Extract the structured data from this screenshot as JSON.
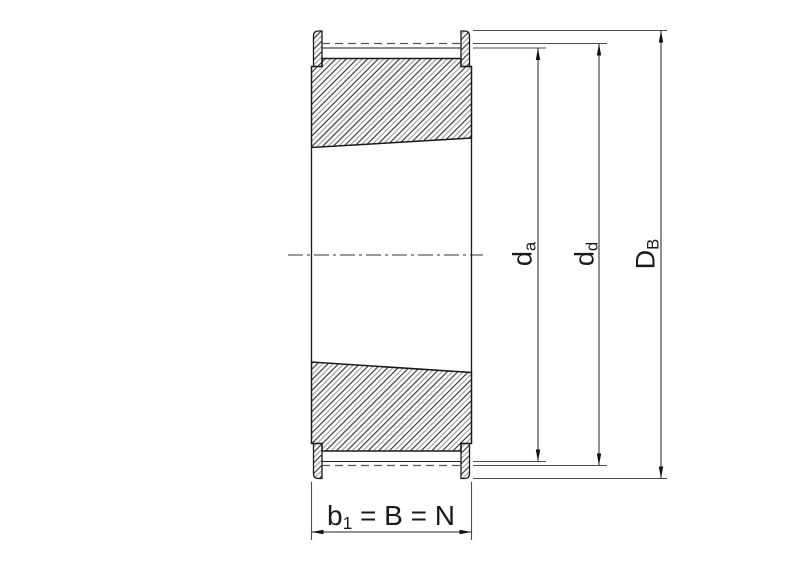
{
  "drawing": {
    "type": "technical-cross-section",
    "subject": "timing-belt pulley with taper bore and flanges",
    "labels": {
      "width_dim": {
        "base": "b",
        "sub": "1",
        "rest": " = B = N"
      },
      "tip_diameter": {
        "base": "d",
        "sub": "a"
      },
      "pitch_diameter": {
        "base": "d",
        "sub": "d"
      },
      "flange_diameter": {
        "base": "D",
        "sub": "B"
      }
    },
    "colors": {
      "line": "#1a1a1a",
      "thin_line": "#4d4d4d",
      "hatch_dark": "#2a2a2a",
      "hatch_light": "#9a9a9a",
      "background": "#ffffff"
    }
  }
}
